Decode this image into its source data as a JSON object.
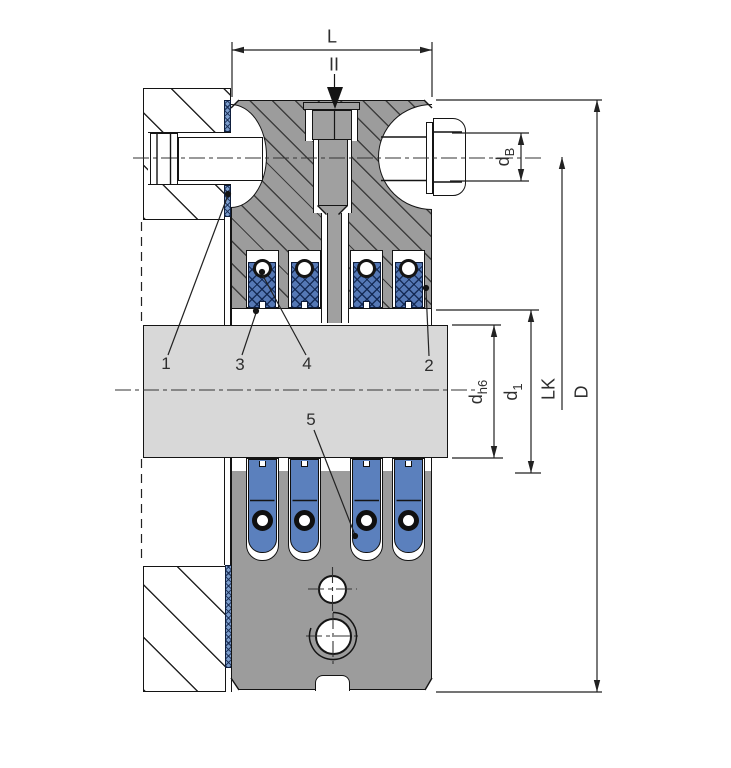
{
  "diagram": {
    "type": "technical-drawing-cross-section",
    "section_marker": "II",
    "dimensions": {
      "L": "L",
      "D": "D",
      "LK": "LK",
      "dB": {
        "base": "d",
        "sub": "B"
      },
      "dh6": {
        "base": "d",
        "sub": "h6"
      },
      "d1": {
        "base": "d",
        "sub": "1"
      }
    },
    "callouts": [
      "1",
      "2",
      "3",
      "4",
      "5"
    ],
    "colors": {
      "hub_gray": "#9c9c9c",
      "shaft_gray": "#d8d8d8",
      "bush_blue": "#5578b5",
      "pin_blue": "#5b80bd",
      "gasket_blue": "#7d9ecd",
      "outline": "#141414",
      "label": "#2e2e2e"
    }
  }
}
